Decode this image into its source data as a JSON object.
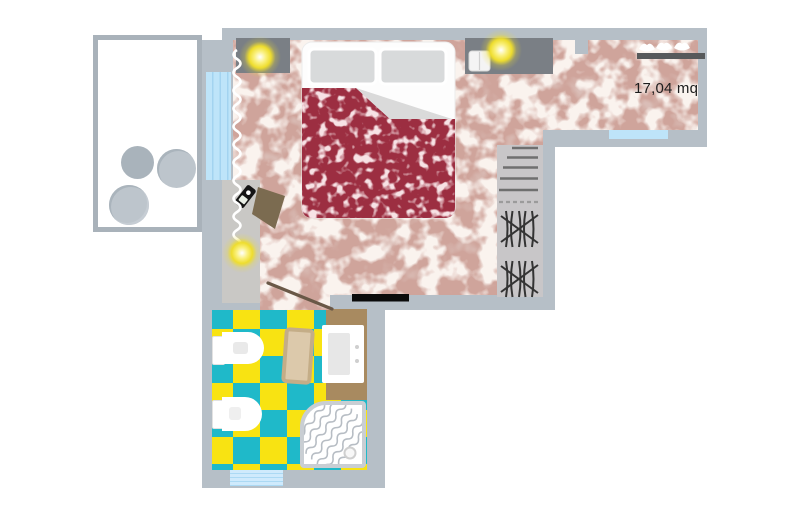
{
  "plan": {
    "area_label": "17,04 mq"
  },
  "colors": {
    "wall": "#b6bfc7",
    "floor_base": "#cfa49b",
    "floor_vein_light": "#f3e6df",
    "floor_vein_dark": "#b07f75",
    "duvet_red": "#9c2e41",
    "bed_white": "#fdfdfd",
    "tile_yellow": "#f8e312",
    "tile_cyan": "#1fb9c9",
    "glass_blue": "#bee4f9",
    "vanity_brown": "#a88a60",
    "bath_mat": "#dcc9ab",
    "lamp_yellow": "#eedd2e",
    "furniture_gray": "#7a7f85",
    "chair_brown": "#7b6b50",
    "entrance_door": "#0b0b0b"
  },
  "symbols": [
    "double-bed",
    "pillows",
    "duvet-folded-corner",
    "nightstand",
    "ceiling-lamp",
    "wardrobe-shelves",
    "clothes-hanging",
    "clothes-rail",
    "coat-hanger",
    "desk",
    "desk-chair",
    "phone",
    "curtain",
    "balcony-stool",
    "toilet",
    "bidet",
    "washbasin-vanity",
    "bath-mat",
    "shower-tray",
    "drain",
    "door-swing",
    "entrance-door",
    "window"
  ]
}
